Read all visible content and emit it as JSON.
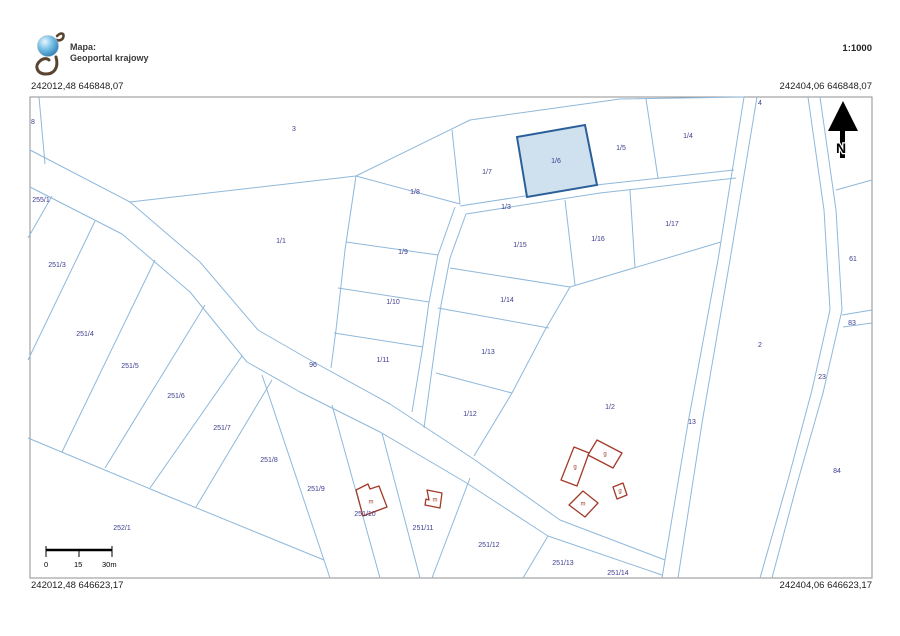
{
  "header": {
    "map_label": "Mapa:",
    "map_name": "Geoportal krajowy",
    "scale": "1:1000"
  },
  "coordinates": {
    "top_left": "242012,48 646848,07",
    "top_right": "242404,06 646848,07",
    "bottom_left": "242012,48 646623,17",
    "bottom_right": "242404,06 646623,17"
  },
  "north_arrow": {
    "label": "N"
  },
  "scale_bar": {
    "tick_labels": [
      "0",
      "15",
      "30m"
    ]
  },
  "map": {
    "label_color": "#3c3c8e",
    "line_color": "#8fb8da",
    "building_color": "#a23b2a",
    "highlighted_parcel": {
      "id": "1/6",
      "fill": "#cfe0ee",
      "border": "#2a6099"
    },
    "parcel_labels": [
      {
        "id": "8",
        "x": 33,
        "y": 123
      },
      {
        "id": "3",
        "x": 294,
        "y": 130
      },
      {
        "id": "255/1",
        "x": 41,
        "y": 201
      },
      {
        "id": "251/3",
        "x": 57,
        "y": 266
      },
      {
        "id": "1/1",
        "x": 281,
        "y": 242
      },
      {
        "id": "251/4",
        "x": 85,
        "y": 335
      },
      {
        "id": "251/5",
        "x": 130,
        "y": 367
      },
      {
        "id": "251/6",
        "x": 176,
        "y": 397
      },
      {
        "id": "251/7",
        "x": 222,
        "y": 429
      },
      {
        "id": "251/8",
        "x": 269,
        "y": 461
      },
      {
        "id": "251/9",
        "x": 316,
        "y": 490
      },
      {
        "id": "96",
        "x": 313,
        "y": 366
      },
      {
        "id": "252/1",
        "x": 122,
        "y": 529
      },
      {
        "id": "251/10",
        "x": 365,
        "y": 515
      },
      {
        "id": "251/11",
        "x": 423,
        "y": 529
      },
      {
        "id": "251/12",
        "x": 489,
        "y": 546
      },
      {
        "id": "251/13",
        "x": 563,
        "y": 564
      },
      {
        "id": "251/14",
        "x": 618,
        "y": 574
      },
      {
        "id": "1/8",
        "x": 415,
        "y": 193
      },
      {
        "id": "1/7",
        "x": 487,
        "y": 173
      },
      {
        "id": "1/6",
        "x": 556,
        "y": 162
      },
      {
        "id": "1/5",
        "x": 621,
        "y": 149
      },
      {
        "id": "1/4",
        "x": 688,
        "y": 137
      },
      {
        "id": "4",
        "x": 760,
        "y": 104
      },
      {
        "id": "1/3",
        "x": 506,
        "y": 208
      },
      {
        "id": "1/15",
        "x": 520,
        "y": 246
      },
      {
        "id": "1/16",
        "x": 598,
        "y": 240
      },
      {
        "id": "1/17",
        "x": 672,
        "y": 225
      },
      {
        "id": "1/9",
        "x": 403,
        "y": 253
      },
      {
        "id": "1/10",
        "x": 393,
        "y": 303
      },
      {
        "id": "1/14",
        "x": 507,
        "y": 301
      },
      {
        "id": "1/13",
        "x": 488,
        "y": 353
      },
      {
        "id": "1/11",
        "x": 383,
        "y": 361
      },
      {
        "id": "1/12",
        "x": 470,
        "y": 415
      },
      {
        "id": "1/2",
        "x": 610,
        "y": 408
      },
      {
        "id": "2",
        "x": 760,
        "y": 346
      },
      {
        "id": "13",
        "x": 692,
        "y": 423
      },
      {
        "id": "61",
        "x": 853,
        "y": 260
      },
      {
        "id": "83",
        "x": 852,
        "y": 324
      },
      {
        "id": "23",
        "x": 822,
        "y": 378
      },
      {
        "id": "84",
        "x": 837,
        "y": 472
      }
    ],
    "building_labels": [
      {
        "letter": "m",
        "x": 371,
        "y": 503
      },
      {
        "letter": "m",
        "x": 435,
        "y": 501
      },
      {
        "letter": "g",
        "x": 575,
        "y": 468
      },
      {
        "letter": "g",
        "x": 605,
        "y": 455
      },
      {
        "letter": "g",
        "x": 620,
        "y": 492
      },
      {
        "letter": "m",
        "x": 583,
        "y": 505
      }
    ]
  }
}
